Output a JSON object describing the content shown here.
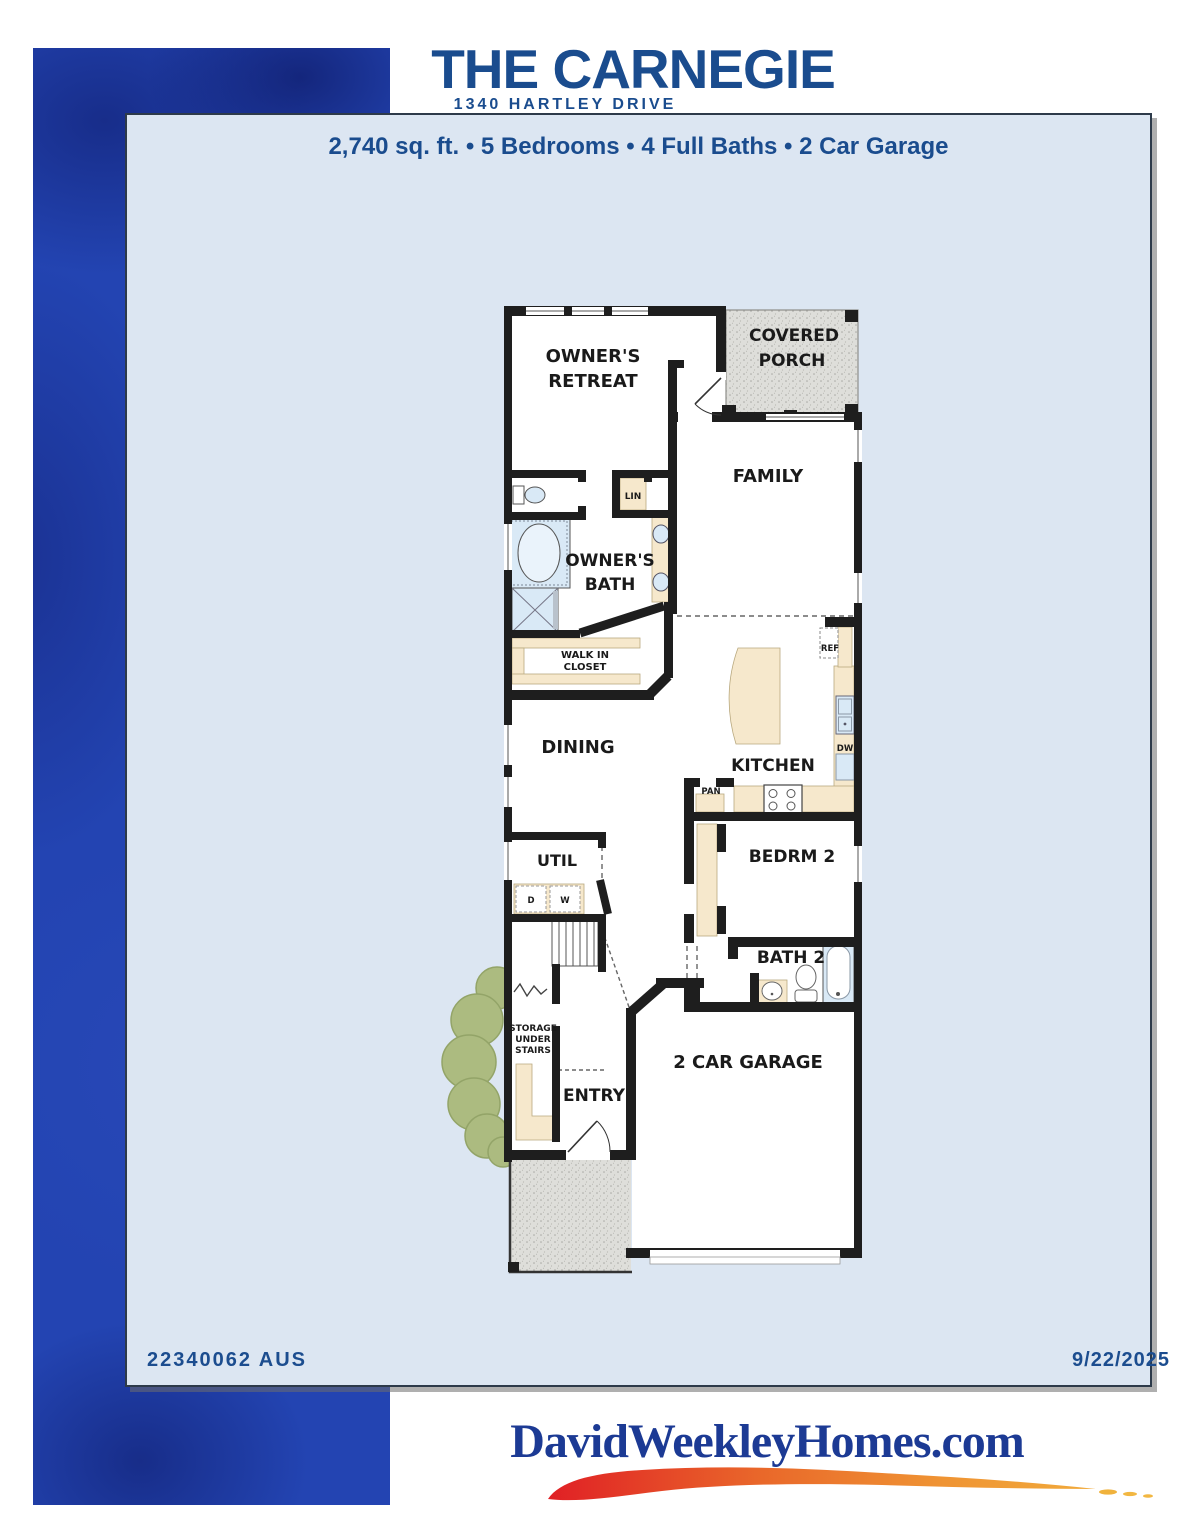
{
  "header": {
    "title": "THE CARNEGIE",
    "subtitle": "1340 HARTLEY DRIVE",
    "specs": "2,740 sq. ft. • 5 Bedrooms • 4 Full Baths • 2 Car Garage"
  },
  "plan": {
    "rooms": {
      "owners_retreat_1": "OWNER'S",
      "owners_retreat_2": "RETREAT",
      "covered_porch_1": "COVERED",
      "covered_porch_2": "PORCH",
      "family": "FAMILY",
      "owners_bath_1": "OWNER'S",
      "owners_bath_2": "BATH",
      "walk_in_closet_1": "WALK IN",
      "walk_in_closet_2": "CLOSET",
      "dining": "DINING",
      "kitchen": "KITCHEN",
      "util": "UTIL",
      "bedrm2": "BEDRM 2",
      "bath2": "BATH 2",
      "storage_1": "STORAGE",
      "storage_2": "UNDER",
      "storage_3": "STAIRS",
      "entry": "ENTRY",
      "garage": "2 CAR GARAGE",
      "lin": "LIN",
      "ref": "REF",
      "dw": "DW",
      "pan": "PAN",
      "dryer": "D",
      "washer": "W"
    }
  },
  "footer": {
    "plan_id": "22340062 AUS",
    "date": "9/22/2025",
    "website": "DavidWeekleyHomes.com"
  },
  "colors": {
    "brand_blue": "#1A4C8E",
    "band_blue": "#2344B2",
    "panel_bg": "#DCE6F2",
    "logo_blue": "#1C3A94",
    "wall_black": "#1E1E1E",
    "casework_cream": "#F6E8CC",
    "fixture_blue": "#D9E9F6",
    "porch_gray": "#DEDEDA",
    "bush_green": "#ACBB80",
    "swoosh_red": "#E02025",
    "swoosh_orange": "#EF9333",
    "swoosh_yellow": "#F2B33E"
  }
}
